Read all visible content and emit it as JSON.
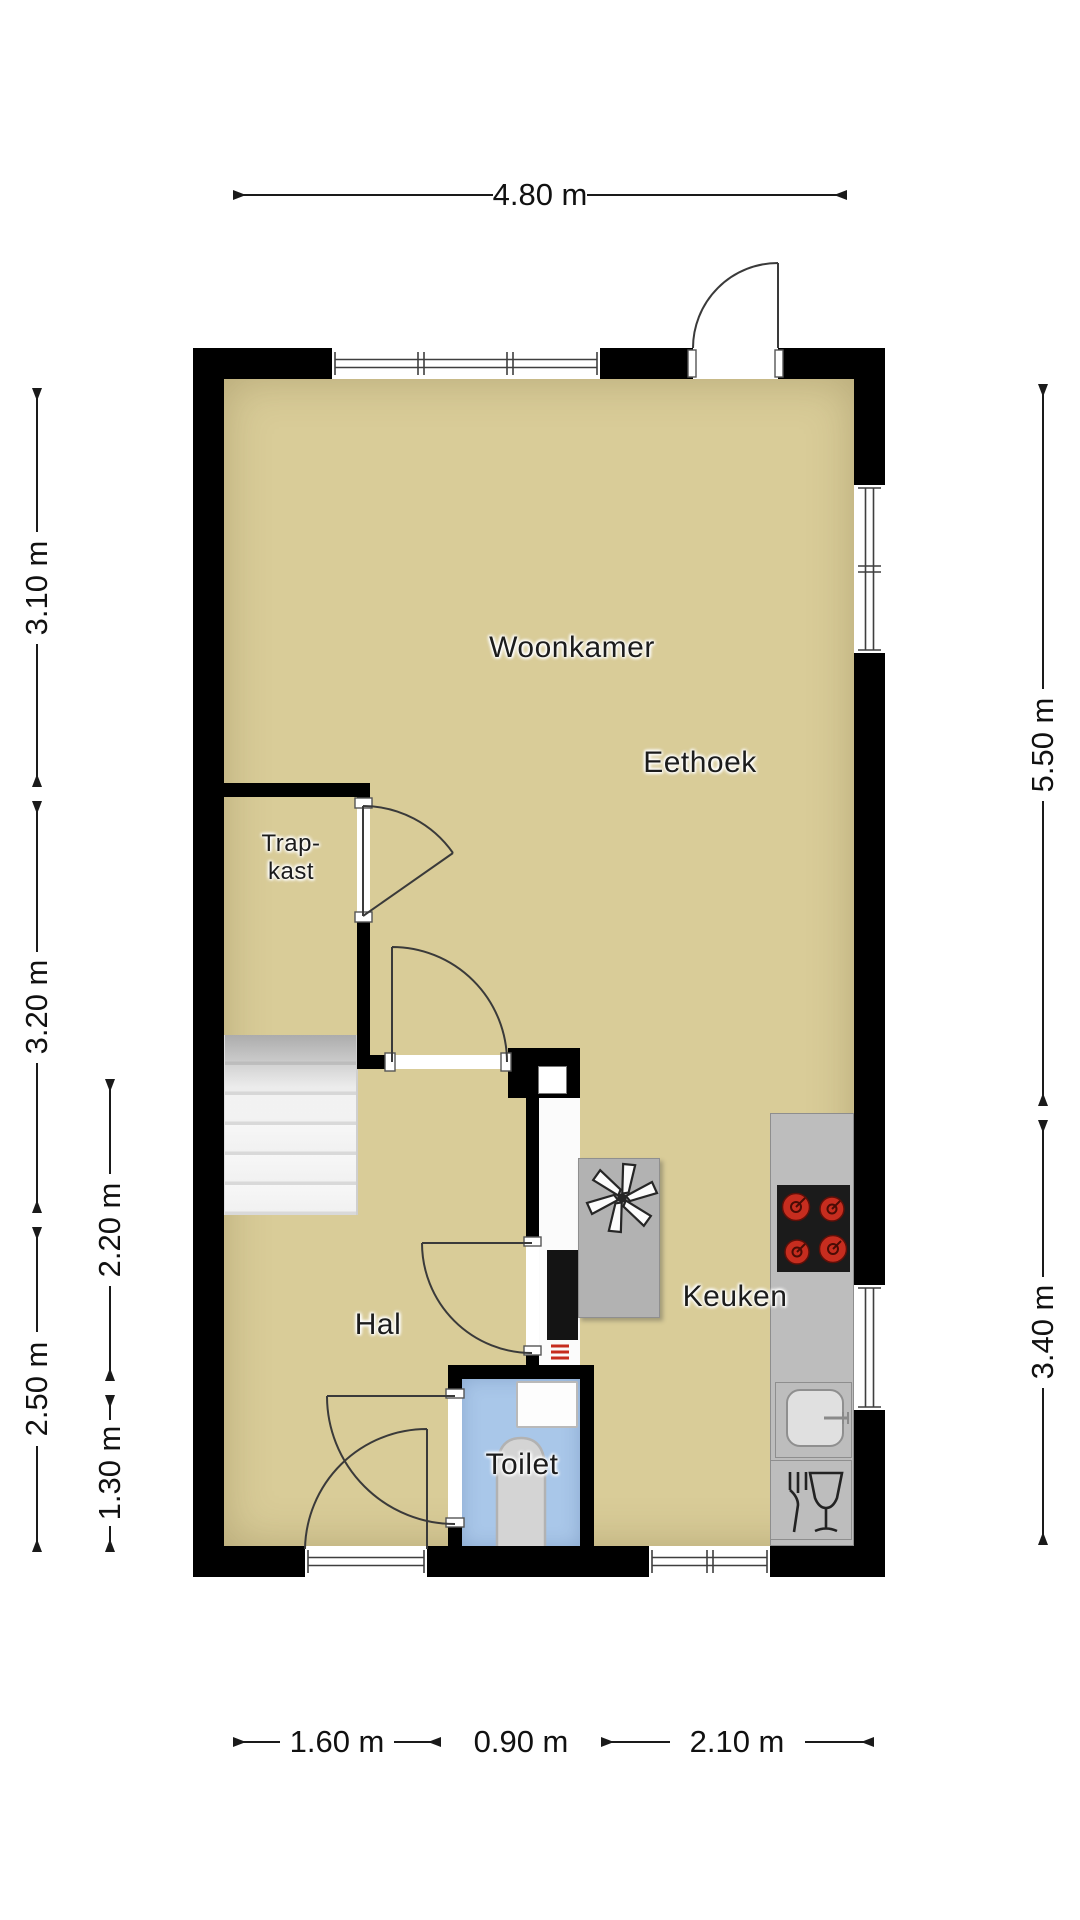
{
  "rooms": {
    "woonkamer": {
      "label": "Woonkamer"
    },
    "eethoek": {
      "label": "Eethoek"
    },
    "trapkast": {
      "line1": "Trap-",
      "line2": "kast"
    },
    "hal": {
      "label": "Hal"
    },
    "toilet": {
      "label": "Toilet"
    },
    "keuken": {
      "label": "Keuken"
    }
  },
  "dims": {
    "top": {
      "label": "4.80 m"
    },
    "left_outer": [
      {
        "label": "3.10 m"
      },
      {
        "label": "3.20 m"
      },
      {
        "label": "2.50 m"
      }
    ],
    "left_inner": [
      {
        "label": "2.20 m"
      },
      {
        "label": "1.30 m"
      }
    ],
    "right": [
      {
        "label": "5.50 m"
      },
      {
        "label": "3.40 m"
      }
    ],
    "bottom": [
      {
        "label": "1.60 m"
      },
      {
        "label": "0.90 m"
      },
      {
        "label": "2.10 m"
      }
    ]
  },
  "colors": {
    "wall": "#000000",
    "floor": "#d9cc98",
    "toilet_floor": "#a9c7e9",
    "counter": "#bdbdbd",
    "island": "#b2b2b2",
    "stove": "#1b1b1b",
    "burner": "#c62d1f",
    "stairs": "#f4f4f4",
    "closet_floor": "#fbfbfb",
    "dimension_text": "#111111",
    "line": "#2a2a2a"
  }
}
